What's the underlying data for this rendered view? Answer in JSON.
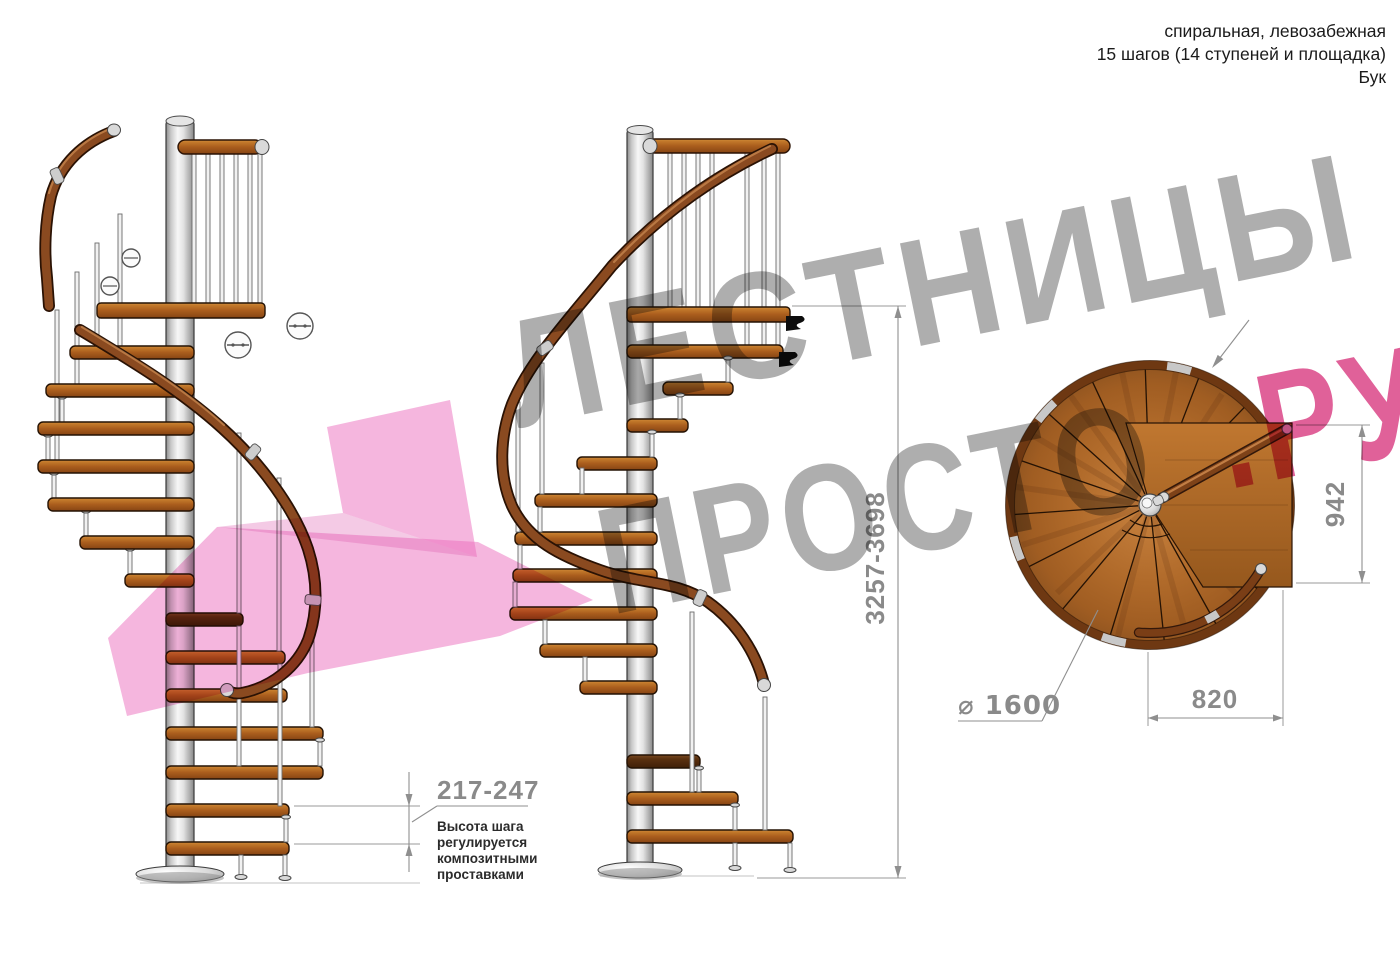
{
  "header": {
    "line1": "спиральная, левозабежная",
    "line2": "15 шагов (14 ступеней и площадка)",
    "line3": "Бук"
  },
  "watermark": {
    "word1": "ЛЕСТНИЦЫ",
    "word2": "ПРОСТО",
    "suffix": ".РУ",
    "gray_color": "#9a9a9a",
    "pink_color": "#e23a7e",
    "arrow_pink": "#f0a9d5"
  },
  "dimensions": {
    "total_height": "3257-3698",
    "landing_depth": "942",
    "landing_width": "820",
    "diameter": "⌀ 1600",
    "step_height": "217-247",
    "step_height_note_lines": [
      "Высота шага",
      "регулируется",
      "композитными",
      "проставками"
    ]
  },
  "colors": {
    "wood": "#aa5d1d",
    "wood_dark": "#6e3812",
    "handrail": "#8a4a20",
    "metal_pole": "#e3e3e3",
    "dimension_gray": "#8a8a8a"
  }
}
